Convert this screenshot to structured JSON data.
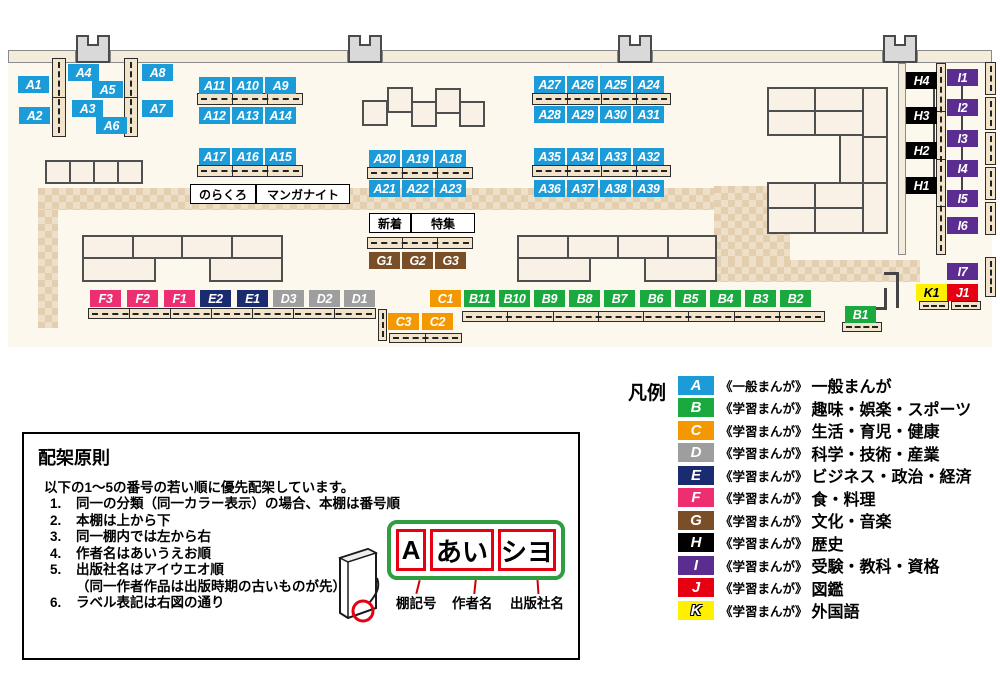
{
  "legend": {
    "title": "凡例",
    "rows": [
      {
        "letter": "A",
        "color": "#1b9cd8",
        "series": "《一般まんが》",
        "category": "一般まんが"
      },
      {
        "letter": "B",
        "color": "#1aa93e",
        "series": "《学習まんが》",
        "category": "趣味・娯楽・スポーツ"
      },
      {
        "letter": "C",
        "color": "#f39800",
        "series": "《学習まんが》",
        "category": "生活・育児・健康"
      },
      {
        "letter": "D",
        "color": "#9e9e9f",
        "series": "《学習まんが》",
        "category": "科学・技術・産業"
      },
      {
        "letter": "E",
        "color": "#1b2b6f",
        "series": "《学習まんが》",
        "category": "ビジネス・政治・経済"
      },
      {
        "letter": "F",
        "color": "#ed2f72",
        "series": "《学習まんが》",
        "category": "食・料理"
      },
      {
        "letter": "G",
        "color": "#7a4e26",
        "series": "《学習まんが》",
        "category": "文化・音楽"
      },
      {
        "letter": "H",
        "color": "#000000",
        "series": "《学習まんが》",
        "category": "歴史"
      },
      {
        "letter": "I",
        "color": "#5c2d91",
        "series": "《学習まんが》",
        "category": "受験・教科・資格"
      },
      {
        "letter": "J",
        "color": "#e60012",
        "series": "《学習まんが》",
        "category": "図鑑"
      },
      {
        "letter": "K",
        "color": "#fff000",
        "series": "《学習まんが》",
        "category": "外国語"
      }
    ]
  },
  "principles": {
    "title": "配架原則",
    "intro": "以下の1～5の番号の若い順に優先配架しています。",
    "items": [
      {
        "num": "1.",
        "text": "同一の分類（同一カラー表示）の場合、本棚は番号順"
      },
      {
        "num": "2.",
        "text": "本棚は上から下"
      },
      {
        "num": "3.",
        "text": "同一棚内では左から右"
      },
      {
        "num": "4.",
        "text": "作者名はあいうえお順"
      },
      {
        "num": "5.",
        "text": "出版社名はアイウエオ順",
        "note": "（同一作者作品は出版時期の古いものが先）"
      },
      {
        "num": "6.",
        "text": "ラベル表記は右図の通り"
      }
    ],
    "label_example": {
      "segments": [
        {
          "text": "A",
          "w": 30
        },
        {
          "text": "あい",
          "w": 64
        },
        {
          "text": "シヨ",
          "w": 58
        }
      ],
      "captions": [
        {
          "text": "棚記号",
          "x": 372
        },
        {
          "text": "作者名",
          "x": 428
        },
        {
          "text": "出版社名",
          "x": 486
        }
      ]
    }
  },
  "map": {
    "callouts": [
      {
        "text": "のらくろ",
        "x": 190,
        "y": 184,
        "w": 64
      },
      {
        "text": "マンガナイト",
        "x": 256,
        "y": 184,
        "w": 92
      },
      {
        "text": "新着",
        "x": 369,
        "y": 213,
        "w": 40
      },
      {
        "text": "特集",
        "x": 411,
        "y": 213,
        "w": 62
      }
    ],
    "labels": [
      {
        "id": "A1",
        "x": 18,
        "y": 76
      },
      {
        "id": "A2",
        "x": 19,
        "y": 107
      },
      {
        "id": "A4",
        "x": 68,
        "y": 64
      },
      {
        "id": "A5",
        "x": 92,
        "y": 81
      },
      {
        "id": "A3",
        "x": 72,
        "y": 100
      },
      {
        "id": "A6",
        "x": 96,
        "y": 117
      },
      {
        "id": "A8",
        "x": 142,
        "y": 64
      },
      {
        "id": "A7",
        "x": 142,
        "y": 100
      },
      {
        "id": "A11",
        "x": 199,
        "y": 77
      },
      {
        "id": "A10",
        "x": 232,
        "y": 77
      },
      {
        "id": "A9",
        "x": 265,
        "y": 77
      },
      {
        "id": "A12",
        "x": 199,
        "y": 107
      },
      {
        "id": "A13",
        "x": 232,
        "y": 107
      },
      {
        "id": "A14",
        "x": 265,
        "y": 107
      },
      {
        "id": "A17",
        "x": 199,
        "y": 148
      },
      {
        "id": "A16",
        "x": 232,
        "y": 148
      },
      {
        "id": "A15",
        "x": 265,
        "y": 148
      },
      {
        "id": "A20",
        "x": 369,
        "y": 150
      },
      {
        "id": "A19",
        "x": 402,
        "y": 150
      },
      {
        "id": "A18",
        "x": 435,
        "y": 150
      },
      {
        "id": "A21",
        "x": 369,
        "y": 180
      },
      {
        "id": "A22",
        "x": 402,
        "y": 180
      },
      {
        "id": "A23",
        "x": 435,
        "y": 180
      },
      {
        "id": "A27",
        "x": 534,
        "y": 76
      },
      {
        "id": "A26",
        "x": 567,
        "y": 76
      },
      {
        "id": "A25",
        "x": 600,
        "y": 76
      },
      {
        "id": "A24",
        "x": 633,
        "y": 76
      },
      {
        "id": "A28",
        "x": 534,
        "y": 106
      },
      {
        "id": "A29",
        "x": 567,
        "y": 106
      },
      {
        "id": "A30",
        "x": 600,
        "y": 106
      },
      {
        "id": "A31",
        "x": 633,
        "y": 106
      },
      {
        "id": "A35",
        "x": 534,
        "y": 148
      },
      {
        "id": "A34",
        "x": 567,
        "y": 148
      },
      {
        "id": "A33",
        "x": 600,
        "y": 148
      },
      {
        "id": "A32",
        "x": 633,
        "y": 148
      },
      {
        "id": "A36",
        "x": 534,
        "y": 180
      },
      {
        "id": "A37",
        "x": 567,
        "y": 180
      },
      {
        "id": "A38",
        "x": 600,
        "y": 180
      },
      {
        "id": "A39",
        "x": 633,
        "y": 180
      },
      {
        "id": "G1",
        "x": 369,
        "y": 252
      },
      {
        "id": "G2",
        "x": 402,
        "y": 252
      },
      {
        "id": "G3",
        "x": 435,
        "y": 252
      },
      {
        "id": "H4",
        "x": 906,
        "y": 72
      },
      {
        "id": "H3",
        "x": 906,
        "y": 107
      },
      {
        "id": "H2",
        "x": 906,
        "y": 142
      },
      {
        "id": "H1",
        "x": 906,
        "y": 177
      },
      {
        "id": "I1",
        "x": 947,
        "y": 69
      },
      {
        "id": "I2",
        "x": 947,
        "y": 99
      },
      {
        "id": "I3",
        "x": 947,
        "y": 130
      },
      {
        "id": "I4",
        "x": 947,
        "y": 160
      },
      {
        "id": "I5",
        "x": 947,
        "y": 190
      },
      {
        "id": "I6",
        "x": 947,
        "y": 217
      },
      {
        "id": "I7",
        "x": 947,
        "y": 263
      },
      {
        "id": "K1",
        "x": 916,
        "y": 284
      },
      {
        "id": "J1",
        "x": 947,
        "y": 284
      },
      {
        "id": "F3",
        "x": 90,
        "y": 290
      },
      {
        "id": "F2",
        "x": 127,
        "y": 290
      },
      {
        "id": "F1",
        "x": 164,
        "y": 290
      },
      {
        "id": "E2",
        "x": 200,
        "y": 290
      },
      {
        "id": "E1",
        "x": 237,
        "y": 290
      },
      {
        "id": "D3",
        "x": 273,
        "y": 290
      },
      {
        "id": "D2",
        "x": 309,
        "y": 290
      },
      {
        "id": "D1",
        "x": 344,
        "y": 290
      },
      {
        "id": "C1",
        "x": 430,
        "y": 290
      },
      {
        "id": "B11",
        "x": 464,
        "y": 290
      },
      {
        "id": "B10",
        "x": 499,
        "y": 290
      },
      {
        "id": "B9",
        "x": 534,
        "y": 290
      },
      {
        "id": "B8",
        "x": 569,
        "y": 290
      },
      {
        "id": "B7",
        "x": 604,
        "y": 290
      },
      {
        "id": "B6",
        "x": 640,
        "y": 290
      },
      {
        "id": "B5",
        "x": 675,
        "y": 290
      },
      {
        "id": "B4",
        "x": 710,
        "y": 290
      },
      {
        "id": "B3",
        "x": 745,
        "y": 290
      },
      {
        "id": "B2",
        "x": 780,
        "y": 290
      },
      {
        "id": "C3",
        "x": 388,
        "y": 313
      },
      {
        "id": "C2",
        "x": 422,
        "y": 313
      },
      {
        "id": "B1",
        "x": 845,
        "y": 306
      }
    ]
  }
}
